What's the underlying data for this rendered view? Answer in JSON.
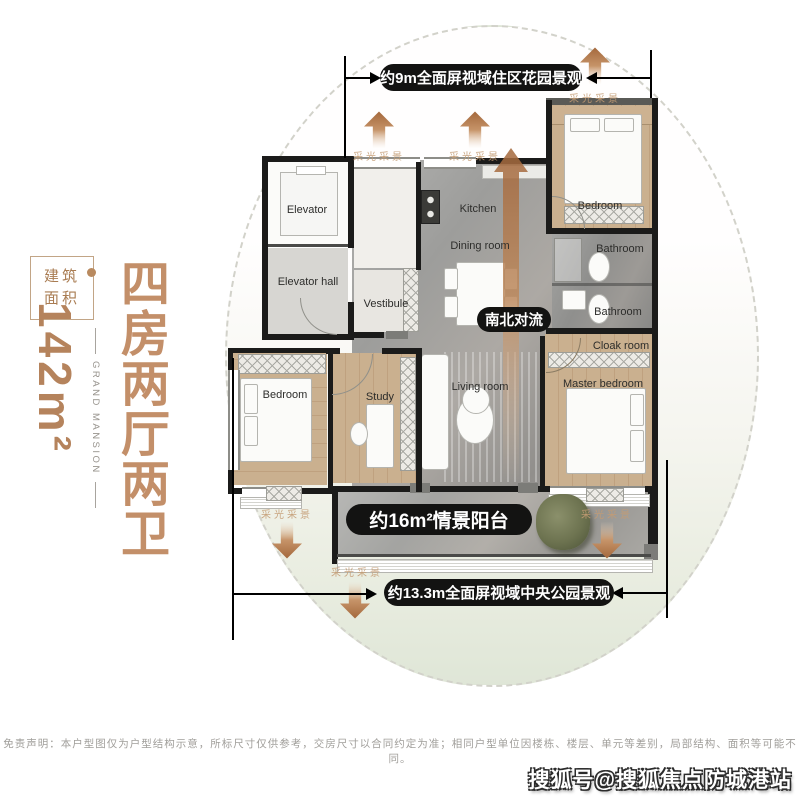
{
  "left_panel": {
    "area_line1": "建筑",
    "area_line2": "面积",
    "area_value": "142m²",
    "brand_en": "GRAND MANSION",
    "headline": "四房两厅两卫"
  },
  "annotations": {
    "top_view": "约9m全面屏视域住区花园景观",
    "bottom_view": "约13.3m全面屏视域中央公园景观",
    "balcony": "约16m²情景阳台",
    "airflow": "南北对流",
    "daylight": "采光采景"
  },
  "rooms": {
    "elevator": "Elevator",
    "elevator_hall": "Elevator hall",
    "vestibule": "Vestibule",
    "kitchen": "Kitchen",
    "dining": "Dining room",
    "bedroom_top": "Bedroom",
    "bathroom_1": "Bathroom",
    "bathroom_2": "Bathroom",
    "cloak": "Cloak room",
    "master": "Master bedroom",
    "living": "Living room",
    "study": "Study",
    "bedroom_left": "Bedroom"
  },
  "footer": {
    "disclaimer": "免责声明：本户型图仅为户型结构示意，所标尺寸仅供参考，交房尺寸以合同约定为准；相同户型单位因楼栋、楼层、单元等差别，局部结构、面积等可能不同。",
    "watermark": "搜狐号@搜狐焦点防城港站"
  },
  "colors": {
    "accent_brown": "#c38f69",
    "bar_black": "#131312",
    "arrow_brown": "#b5714a",
    "wood_floor": "#c9ae8f",
    "marble_floor": "#a3a19d",
    "sage_bg": "#e6ebdf"
  }
}
